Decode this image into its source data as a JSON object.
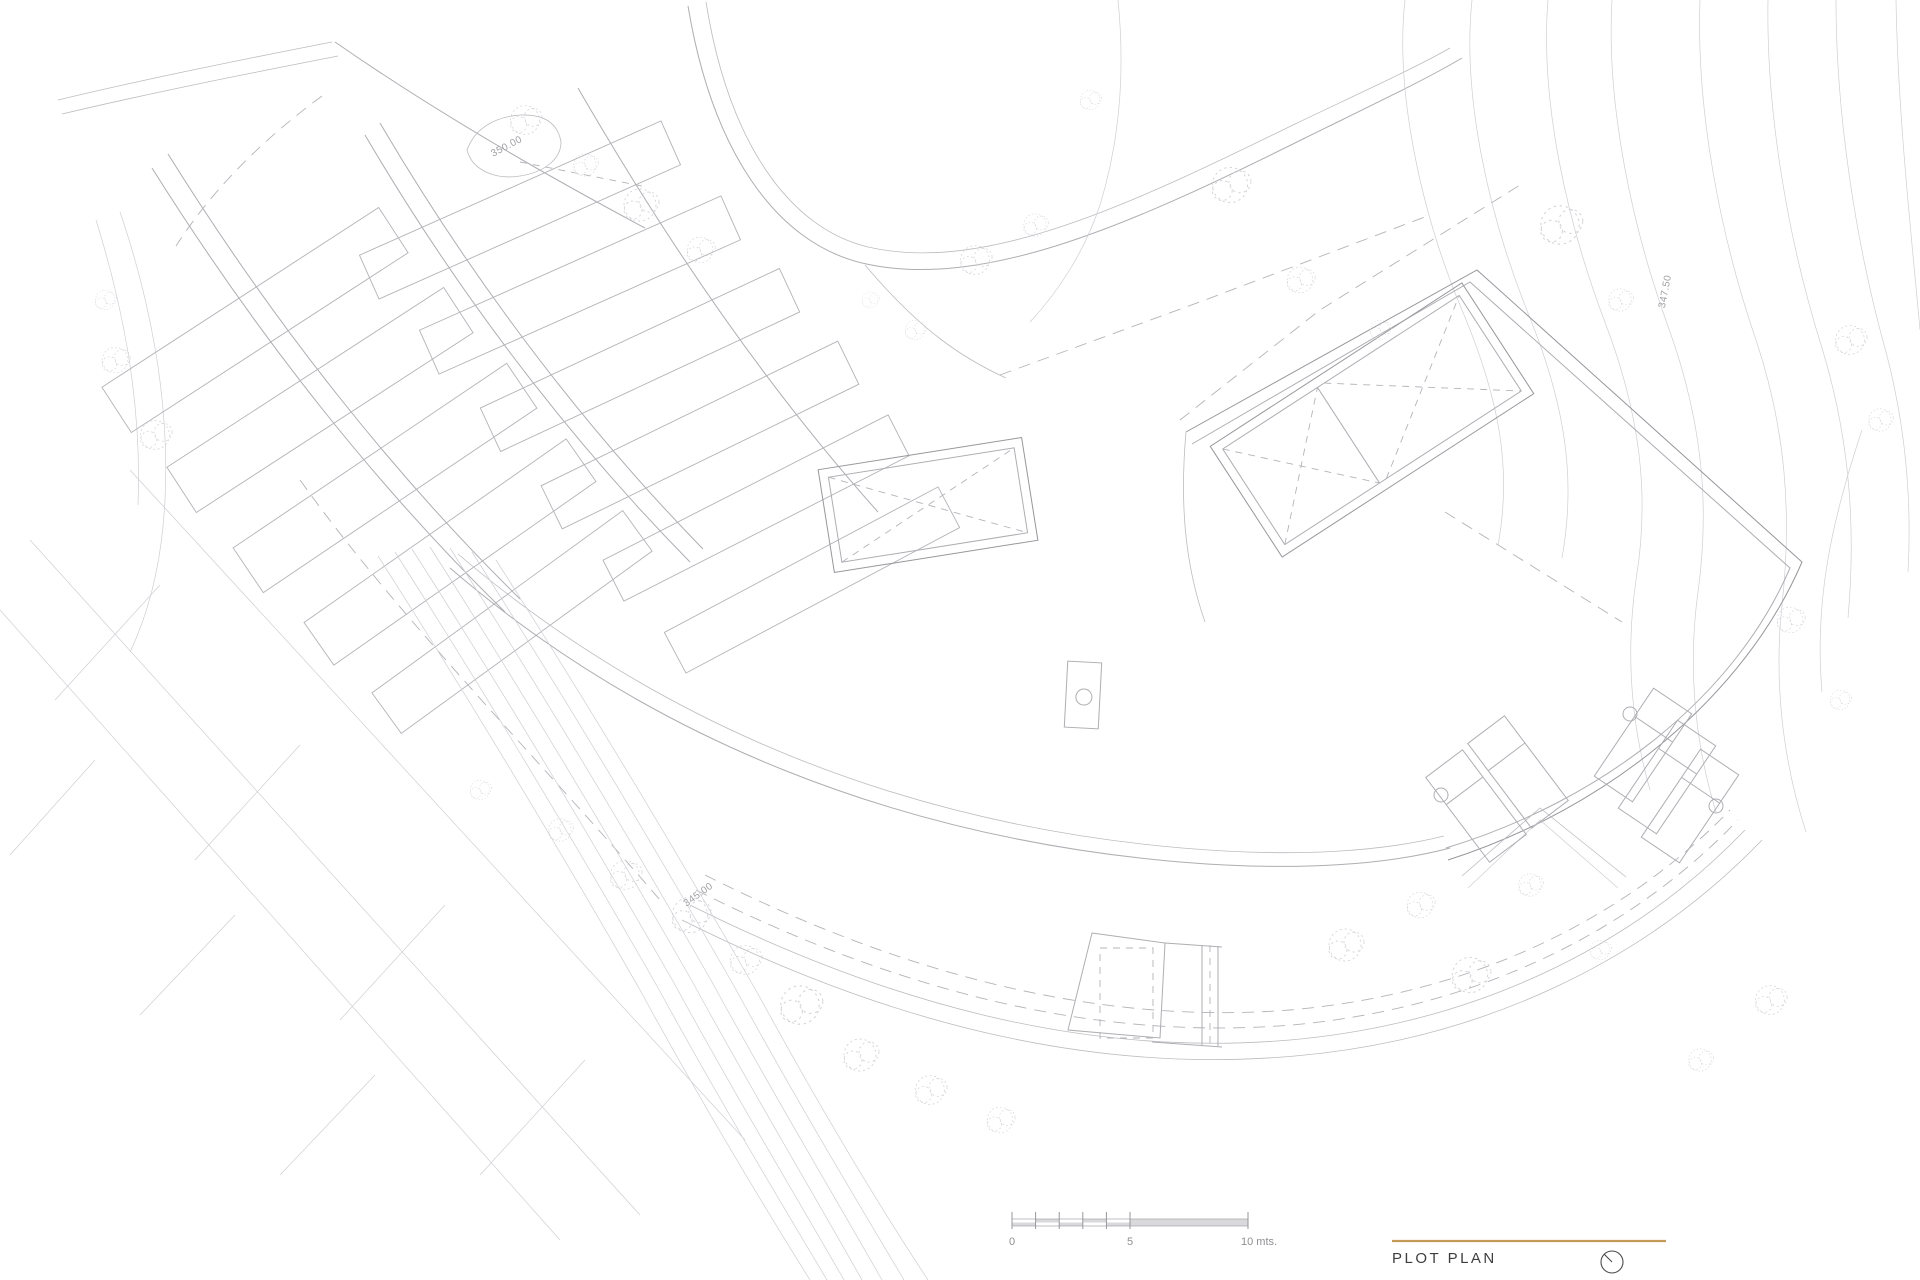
{
  "drawing": {
    "title": "PLOT PLAN",
    "accent_gold": "#c49a58",
    "line_gray": "#aeaeb3",
    "labels": {
      "elev_350": "350.00",
      "elev_347": "347.50",
      "elev_345": "345.00"
    },
    "scale_bar": {
      "tick_0": "0",
      "tick_5": "5",
      "tick_10": "10 mts."
    }
  }
}
